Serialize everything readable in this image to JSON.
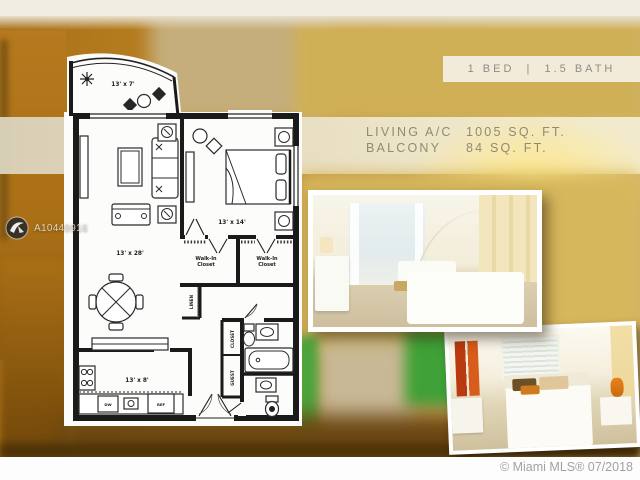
{
  "header": {
    "bed_bath": "1 BED  |  1.5 BATH"
  },
  "stats": {
    "rows": [
      {
        "label": "LIVING A/C",
        "value": "1005 SQ. FT."
      },
      {
        "label": "BALCONY",
        "value": "84 SQ. FT."
      }
    ]
  },
  "floor_plan": {
    "balcony_dim": "13' x 7'",
    "living_dim": "13' x 28'",
    "bedroom_dim": "13' x 14'",
    "kitchen_dim": "13' x 8'",
    "walk_in_closet_left": {
      "line1": "Walk-In",
      "line2": "Closet"
    },
    "walk_in_closet_right": {
      "line1": "Walk-In",
      "line2": "Closet"
    },
    "linen_label": "LINEN",
    "closet_label": "CLOSET",
    "guest_label": "GUEST",
    "dishwasher_label": "DW",
    "refrigerator_label": "REF"
  },
  "watermark": {
    "mls_number": "A10449916"
  },
  "footer": {
    "copyright": "© Miami MLS® 07/2018"
  },
  "colors": {
    "accent_gold": "#d0b056",
    "band_cream": "#efe8cd",
    "background_orange": "#b5791e",
    "green_accent": "#3fa138",
    "photo_frame": "#ffffff"
  }
}
